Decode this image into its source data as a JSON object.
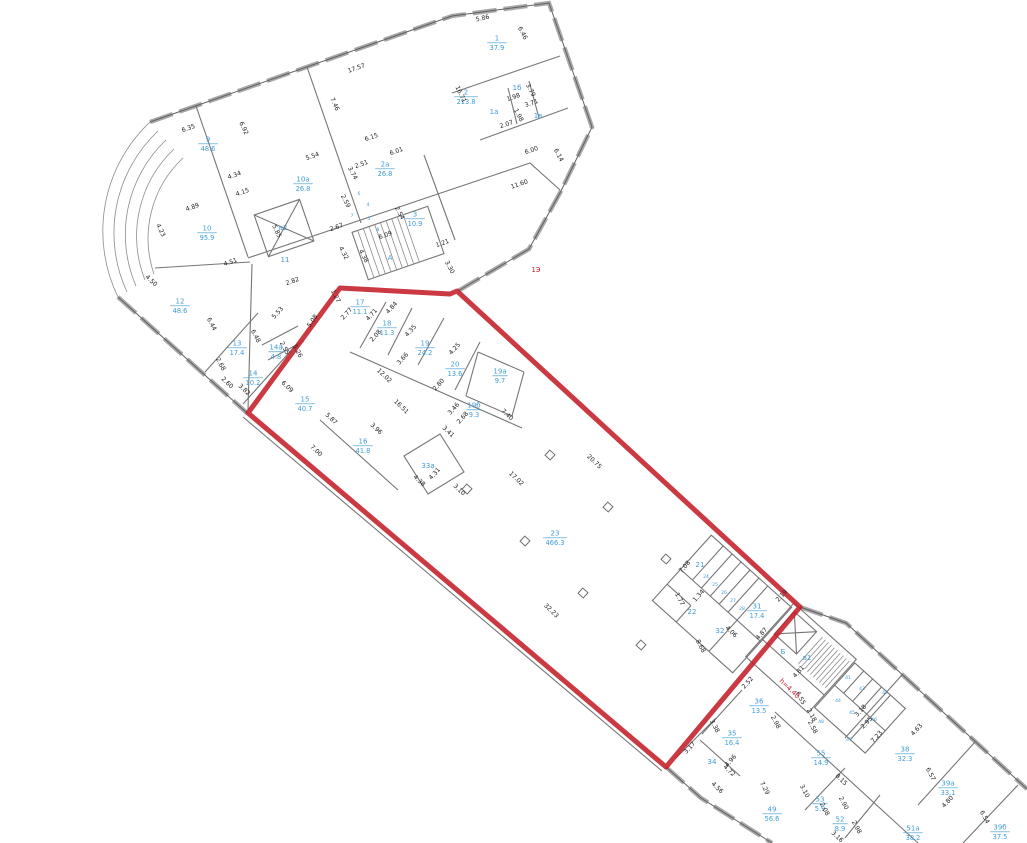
{
  "plan": {
    "title": "floor-plan with red selected area",
    "colors": {
      "room_label": "#3f9cd6",
      "dimension_text": "#222222",
      "selected_boundary": "#c41e28",
      "wall": "#767676",
      "red_annotation": "#c41e28"
    },
    "rooms": [
      {
        "n": "1",
        "a": "37.9",
        "x": 497,
        "y": 42
      },
      {
        "n": "1б",
        "a": "",
        "x": 517,
        "y": 88
      },
      {
        "n": "1а",
        "a": "",
        "x": 494,
        "y": 112
      },
      {
        "n": "1в",
        "a": "",
        "x": 538,
        "y": 116
      },
      {
        "n": "2",
        "a": "213.8",
        "x": 466,
        "y": 96
      },
      {
        "n": "2а",
        "a": "26.8",
        "x": 385,
        "y": 168
      },
      {
        "n": "3",
        "a": "10.9",
        "x": 415,
        "y": 218
      },
      {
        "n": "9",
        "a": "48.6",
        "x": 208,
        "y": 143
      },
      {
        "n": "10а",
        "a": "26.8",
        "x": 303,
        "y": 183
      },
      {
        "n": "10",
        "a": "95.9",
        "x": 207,
        "y": 232
      },
      {
        "n": "11",
        "a": "",
        "x": 285,
        "y": 260
      },
      {
        "n": "в2",
        "a": "",
        "x": 283,
        "y": 228
      },
      {
        "n": "А",
        "a": "",
        "x": 390,
        "y": 258
      },
      {
        "n": "6",
        "a": "",
        "x": 359,
        "y": 193,
        "s": 1
      },
      {
        "n": "4",
        "a": "",
        "x": 368,
        "y": 204,
        "s": 1
      },
      {
        "n": "7",
        "a": "",
        "x": 352,
        "y": 215,
        "s": 1
      },
      {
        "n": "5",
        "a": "",
        "x": 369,
        "y": 218,
        "s": 1
      },
      {
        "n": "8",
        "a": "",
        "x": 378,
        "y": 229,
        "s": 1
      },
      {
        "n": "12",
        "a": "48.6",
        "x": 180,
        "y": 305
      },
      {
        "n": "13",
        "a": "17.4",
        "x": 237,
        "y": 347
      },
      {
        "n": "14а",
        "a": "4.8",
        "x": 276,
        "y": 351
      },
      {
        "n": "14",
        "a": "10.2",
        "x": 253,
        "y": 377
      },
      {
        "n": "15",
        "a": "40.7",
        "x": 305,
        "y": 403
      },
      {
        "n": "16",
        "a": "41.8",
        "x": 363,
        "y": 445
      },
      {
        "n": "17",
        "a": "11.1",
        "x": 360,
        "y": 306
      },
      {
        "n": "18",
        "a": "11.3",
        "x": 387,
        "y": 327
      },
      {
        "n": "19",
        "a": "24.2",
        "x": 425,
        "y": 347
      },
      {
        "n": "20",
        "a": "13.6",
        "x": 455,
        "y": 368
      },
      {
        "n": "19а",
        "a": "9.7",
        "x": 500,
        "y": 375
      },
      {
        "n": "19б",
        "a": "9.3",
        "x": 474,
        "y": 409
      },
      {
        "n": "33а",
        "a": "",
        "x": 428,
        "y": 466
      },
      {
        "n": "23",
        "a": "466.3",
        "x": 555,
        "y": 537
      },
      {
        "n": "21",
        "a": "",
        "x": 700,
        "y": 565
      },
      {
        "n": "22",
        "a": "",
        "x": 692,
        "y": 612
      },
      {
        "n": "24",
        "a": "",
        "x": 706,
        "y": 576,
        "s": 1
      },
      {
        "n": "25",
        "a": "",
        "x": 715,
        "y": 584,
        "s": 1
      },
      {
        "n": "26",
        "a": "",
        "x": 724,
        "y": 592,
        "s": 1
      },
      {
        "n": "27",
        "a": "",
        "x": 733,
        "y": 600,
        "s": 1
      },
      {
        "n": "28",
        "a": "",
        "x": 742,
        "y": 608,
        "s": 1
      },
      {
        "n": "31",
        "a": "17.4",
        "x": 757,
        "y": 610
      },
      {
        "n": "32",
        "a": "",
        "x": 720,
        "y": 631
      },
      {
        "n": "Б",
        "a": "",
        "x": 783,
        "y": 652
      },
      {
        "n": "в1",
        "a": "",
        "x": 807,
        "y": 658
      },
      {
        "n": "41",
        "a": "",
        "x": 848,
        "y": 677,
        "s": 1
      },
      {
        "n": "42",
        "a": "",
        "x": 885,
        "y": 692,
        "s": 1
      },
      {
        "n": "43",
        "a": "",
        "x": 862,
        "y": 688,
        "s": 1
      },
      {
        "n": "44",
        "a": "",
        "x": 838,
        "y": 700,
        "s": 1
      },
      {
        "n": "45",
        "a": "",
        "x": 852,
        "y": 712,
        "s": 1
      },
      {
        "n": "46",
        "a": "",
        "x": 874,
        "y": 719,
        "s": 1
      },
      {
        "n": "47",
        "a": "",
        "x": 849,
        "y": 739,
        "s": 1
      },
      {
        "n": "48",
        "a": "",
        "x": 821,
        "y": 721,
        "s": 1
      },
      {
        "n": "36",
        "a": "13.5",
        "x": 759,
        "y": 705
      },
      {
        "n": "35",
        "a": "16.4",
        "x": 732,
        "y": 737
      },
      {
        "n": "34",
        "a": "",
        "x": 712,
        "y": 762
      },
      {
        "n": "55",
        "a": "14.9",
        "x": 821,
        "y": 757
      },
      {
        "n": "38",
        "a": "32.3",
        "x": 905,
        "y": 753
      },
      {
        "n": "39а",
        "a": "33.1",
        "x": 948,
        "y": 787
      },
      {
        "n": "39б",
        "a": "37.5",
        "x": 1000,
        "y": 831
      },
      {
        "n": "51а",
        "a": "38.2",
        "x": 913,
        "y": 832
      },
      {
        "n": "52",
        "a": "8.9",
        "x": 840,
        "y": 823
      },
      {
        "n": "53",
        "a": "5.9",
        "x": 820,
        "y": 803
      },
      {
        "n": "49",
        "a": "56.6",
        "x": 772,
        "y": 813
      }
    ],
    "dimensions": [
      {
        "t": "5.86",
        "x": 483,
        "y": 20,
        "a": -13
      },
      {
        "t": "6.46",
        "x": 521,
        "y": 34,
        "a": 62
      },
      {
        "t": "17.57",
        "x": 357,
        "y": 70,
        "a": -19
      },
      {
        "t": "7.46",
        "x": 333,
        "y": 105,
        "a": 65
      },
      {
        "t": "16.71",
        "x": 459,
        "y": 95,
        "a": 65
      },
      {
        "t": "1.98",
        "x": 514,
        "y": 99,
        "a": -19
      },
      {
        "t": "3.79",
        "x": 529,
        "y": 91,
        "a": 62
      },
      {
        "t": "3.71",
        "x": 532,
        "y": 105,
        "a": -19
      },
      {
        "t": "1.98",
        "x": 517,
        "y": 116,
        "a": 62
      },
      {
        "t": "2.07",
        "x": 507,
        "y": 126,
        "a": -19
      },
      {
        "t": "6.00",
        "x": 532,
        "y": 152,
        "a": -19
      },
      {
        "t": "6.14",
        "x": 557,
        "y": 156,
        "a": 62
      },
      {
        "t": "11.60",
        "x": 520,
        "y": 186,
        "a": -19
      },
      {
        "t": "6.35",
        "x": 189,
        "y": 130,
        "a": -19
      },
      {
        "t": "6.92",
        "x": 242,
        "y": 129,
        "a": 65
      },
      {
        "t": "5.54",
        "x": 313,
        "y": 158,
        "a": -19
      },
      {
        "t": "3.74",
        "x": 351,
        "y": 174,
        "a": 62
      },
      {
        "t": "2.51",
        "x": 362,
        "y": 166,
        "a": -19
      },
      {
        "t": "6.15",
        "x": 372,
        "y": 139,
        "a": -19
      },
      {
        "t": "6.01",
        "x": 397,
        "y": 153,
        "a": -19
      },
      {
        "t": "2.54",
        "x": 398,
        "y": 214,
        "a": 62
      },
      {
        "t": "2.59",
        "x": 344,
        "y": 202,
        "a": 62
      },
      {
        "t": "2.67",
        "x": 337,
        "y": 229,
        "a": -19
      },
      {
        "t": "6.09",
        "x": 386,
        "y": 237,
        "a": -19
      },
      {
        "t": "4.32",
        "x": 342,
        "y": 254,
        "a": 62
      },
      {
        "t": "4.38",
        "x": 362,
        "y": 257,
        "a": 62
      },
      {
        "t": "1.21",
        "x": 443,
        "y": 245,
        "a": -19
      },
      {
        "t": "3.30",
        "x": 448,
        "y": 268,
        "a": 62
      },
      {
        "t": "4.34",
        "x": 235,
        "y": 177,
        "a": -19
      },
      {
        "t": "4.15",
        "x": 243,
        "y": 194,
        "a": -19
      },
      {
        "t": "4.89",
        "x": 193,
        "y": 209,
        "a": -19
      },
      {
        "t": "4.23",
        "x": 159,
        "y": 231,
        "a": 65
      },
      {
        "t": "5.85",
        "x": 275,
        "y": 232,
        "a": 65
      },
      {
        "t": "4.51",
        "x": 231,
        "y": 264,
        "a": -19
      },
      {
        "t": "2.82",
        "x": 293,
        "y": 283,
        "a": -19
      },
      {
        "t": "4.50",
        "x": 150,
        "y": 282,
        "a": 44
      },
      {
        "t": "6.44",
        "x": 210,
        "y": 325,
        "a": 62
      },
      {
        "t": "5.53",
        "x": 279,
        "y": 314,
        "a": -48
      },
      {
        "t": "6.48",
        "x": 254,
        "y": 337,
        "a": 62
      },
      {
        "t": "2.55",
        "x": 283,
        "y": 349,
        "a": 62
      },
      {
        "t": "5.26",
        "x": 296,
        "y": 352,
        "a": 62
      },
      {
        "t": "2.68",
        "x": 219,
        "y": 365,
        "a": 62
      },
      {
        "t": "2.60",
        "x": 226,
        "y": 384,
        "a": 44
      },
      {
        "t": "3.82",
        "x": 243,
        "y": 391,
        "a": 44
      },
      {
        "t": "1.27",
        "x": 334,
        "y": 297,
        "a": 62
      },
      {
        "t": "5.08",
        "x": 314,
        "y": 322,
        "a": -56
      },
      {
        "t": "2.77",
        "x": 348,
        "y": 315,
        "a": -48
      },
      {
        "t": "4.71",
        "x": 373,
        "y": 316,
        "a": -48
      },
      {
        "t": "4.84",
        "x": 393,
        "y": 309,
        "a": -48
      },
      {
        "t": "2.08",
        "x": 377,
        "y": 337,
        "a": -48
      },
      {
        "t": "4.35",
        "x": 412,
        "y": 332,
        "a": -48
      },
      {
        "t": "3.66",
        "x": 404,
        "y": 360,
        "a": -48
      },
      {
        "t": "12.02",
        "x": 383,
        "y": 377,
        "a": 44
      },
      {
        "t": "4.25",
        "x": 456,
        "y": 350,
        "a": -48
      },
      {
        "t": "2.80",
        "x": 440,
        "y": 386,
        "a": -48
      },
      {
        "t": "3.46",
        "x": 455,
        "y": 410,
        "a": -48
      },
      {
        "t": "2.68",
        "x": 464,
        "y": 419,
        "a": -48
      },
      {
        "t": "3.41",
        "x": 447,
        "y": 433,
        "a": 44
      },
      {
        "t": "7.40",
        "x": 506,
        "y": 416,
        "a": 44
      },
      {
        "t": "16.51",
        "x": 400,
        "y": 408,
        "a": 44
      },
      {
        "t": "3.96",
        "x": 375,
        "y": 430,
        "a": 44
      },
      {
        "t": "7.00",
        "x": 315,
        "y": 452,
        "a": 44
      },
      {
        "t": "6.09",
        "x": 286,
        "y": 388,
        "a": 44
      },
      {
        "t": "5.87",
        "x": 330,
        "y": 420,
        "a": 44
      },
      {
        "t": "4.38",
        "x": 418,
        "y": 482,
        "a": 44
      },
      {
        "t": "4.31",
        "x": 436,
        "y": 475,
        "a": -48
      },
      {
        "t": "3.10",
        "x": 458,
        "y": 491,
        "a": 44
      },
      {
        "t": "17.02",
        "x": 515,
        "y": 480,
        "a": 44
      },
      {
        "t": "20.75",
        "x": 593,
        "y": 463,
        "a": 44
      },
      {
        "t": "32.23",
        "x": 550,
        "y": 612,
        "a": 44
      },
      {
        "t": "7.08",
        "x": 686,
        "y": 568,
        "a": -48
      },
      {
        "t": "2.19",
        "x": 783,
        "y": 597,
        "a": -48
      },
      {
        "t": "1.77",
        "x": 678,
        "y": 600,
        "a": 62
      },
      {
        "t": "1.34",
        "x": 700,
        "y": 597,
        "a": -48
      },
      {
        "t": "4.06",
        "x": 730,
        "y": 633,
        "a": 44
      },
      {
        "t": "4.87",
        "x": 763,
        "y": 635,
        "a": -48
      },
      {
        "t": "8.68",
        "x": 699,
        "y": 647,
        "a": 62
      },
      {
        "t": "6.55",
        "x": 799,
        "y": 699,
        "a": 62
      },
      {
        "t": "4.81",
        "x": 800,
        "y": 673,
        "a": -48
      },
      {
        "t": "2.52",
        "x": 749,
        "y": 684,
        "a": -48
      },
      {
        "t": "2.98",
        "x": 774,
        "y": 723,
        "a": 62
      },
      {
        "t": "3.38",
        "x": 713,
        "y": 727,
        "a": 62
      },
      {
        "t": "3.17",
        "x": 691,
        "y": 749,
        "a": -48
      },
      {
        "t": "4.96",
        "x": 732,
        "y": 762,
        "a": -48
      },
      {
        "t": "4.72",
        "x": 728,
        "y": 772,
        "a": 44
      },
      {
        "t": "4.56",
        "x": 716,
        "y": 789,
        "a": 44
      },
      {
        "t": "7.29",
        "x": 763,
        "y": 789,
        "a": 62
      },
      {
        "t": "3.10",
        "x": 803,
        "y": 792,
        "a": 62
      },
      {
        "t": "8.15",
        "x": 840,
        "y": 781,
        "a": 44
      },
      {
        "t": "2.08",
        "x": 823,
        "y": 810,
        "a": 62
      },
      {
        "t": "2.90",
        "x": 842,
        "y": 804,
        "a": 62
      },
      {
        "t": "2.18",
        "x": 810,
        "y": 716,
        "a": 62
      },
      {
        "t": "2.58",
        "x": 811,
        "y": 728,
        "a": 62
      },
      {
        "t": "3.18",
        "x": 862,
        "y": 712,
        "a": -48
      },
      {
        "t": "2.95",
        "x": 868,
        "y": 724,
        "a": -48
      },
      {
        "t": "7.23",
        "x": 878,
        "y": 738,
        "a": -48
      },
      {
        "t": "4.63",
        "x": 918,
        "y": 731,
        "a": -48
      },
      {
        "t": "6.57",
        "x": 929,
        "y": 775,
        "a": 62
      },
      {
        "t": "4.80",
        "x": 949,
        "y": 803,
        "a": -48
      },
      {
        "t": "6.54",
        "x": 983,
        "y": 818,
        "a": 62
      },
      {
        "t": "2.98",
        "x": 855,
        "y": 828,
        "a": 62
      },
      {
        "t": "3.16",
        "x": 836,
        "y": 838,
        "a": 44
      }
    ],
    "annotations": [
      {
        "t": "h=4.40",
        "x": 788,
        "y": 690,
        "a": 44
      },
      {
        "t": "1Э",
        "x": 536,
        "y": 272,
        "a": 0
      }
    ]
  }
}
